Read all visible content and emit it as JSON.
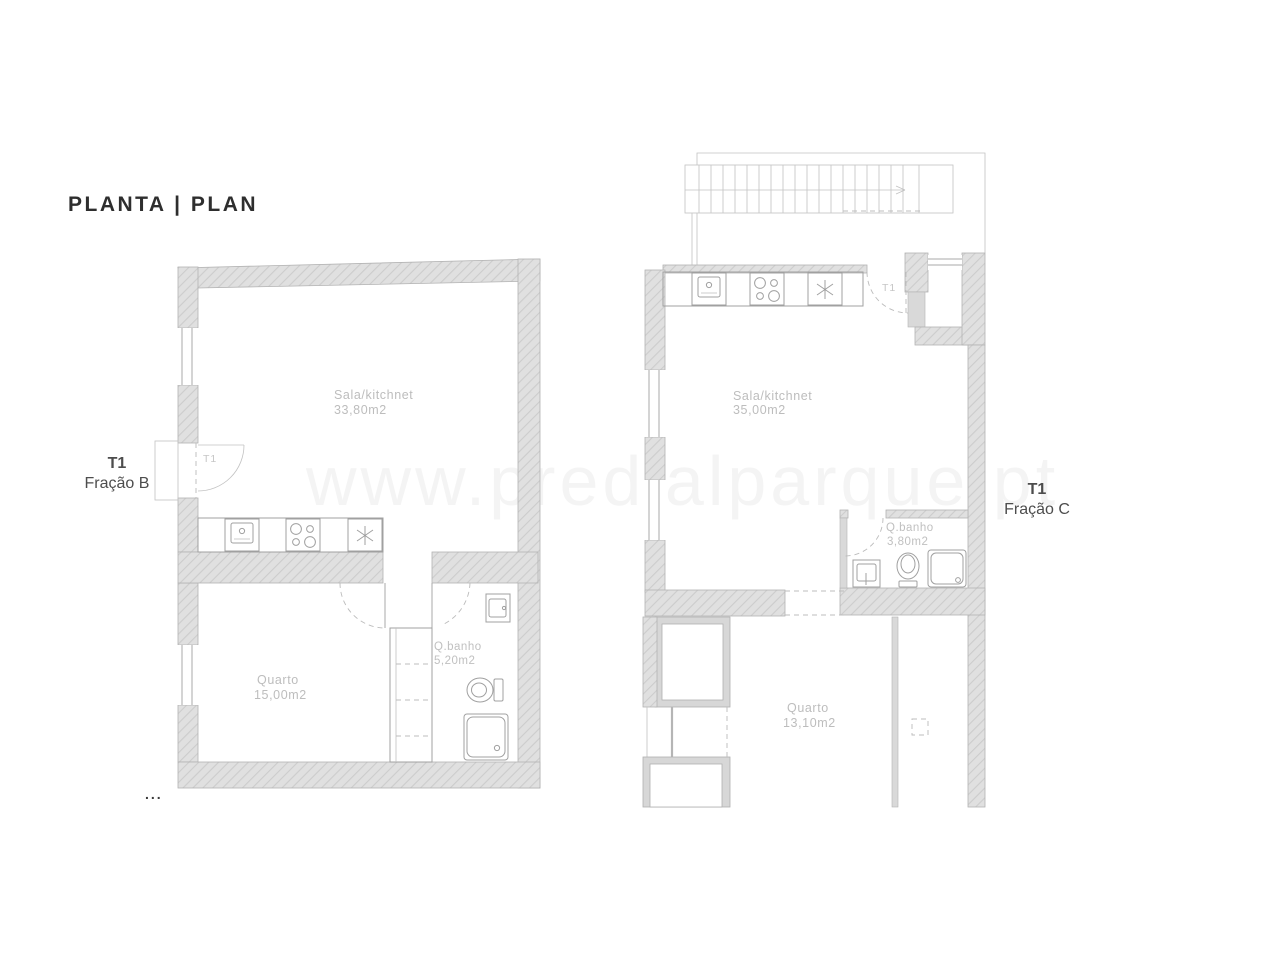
{
  "page": {
    "title": "PLANTA | PLAN",
    "watermark": "www.predialparque.pt",
    "ellipsis": "..."
  },
  "colors": {
    "wall_fill": "#e0e0e0",
    "wall_hatch": "#cccccc",
    "wall_stroke": "#b3b3b3",
    "fixture_line": "#a0a0a0",
    "room_label": "#bdbdbd",
    "title_text": "#2e2e2e",
    "unit_label": "#4d4d4d"
  },
  "units": [
    {
      "code": "T1",
      "name": "Fração B",
      "door_label": "T1",
      "rooms": {
        "sala": {
          "name": "Sala/kitchnet",
          "area": "33,80m2"
        },
        "quarto": {
          "name": "Quarto",
          "area": "15,00m2"
        },
        "banho": {
          "name": "Q.banho",
          "area": "5,20m2"
        }
      }
    },
    {
      "code": "T1",
      "name": "Fração C",
      "door_label": "T1",
      "rooms": {
        "sala": {
          "name": "Sala/kitchnet",
          "area": "35,00m2"
        },
        "banho": {
          "name": "Q.banho",
          "area": "3,80m2"
        },
        "quarto": {
          "name": "Quarto",
          "area": "13,10m2"
        }
      }
    }
  ]
}
